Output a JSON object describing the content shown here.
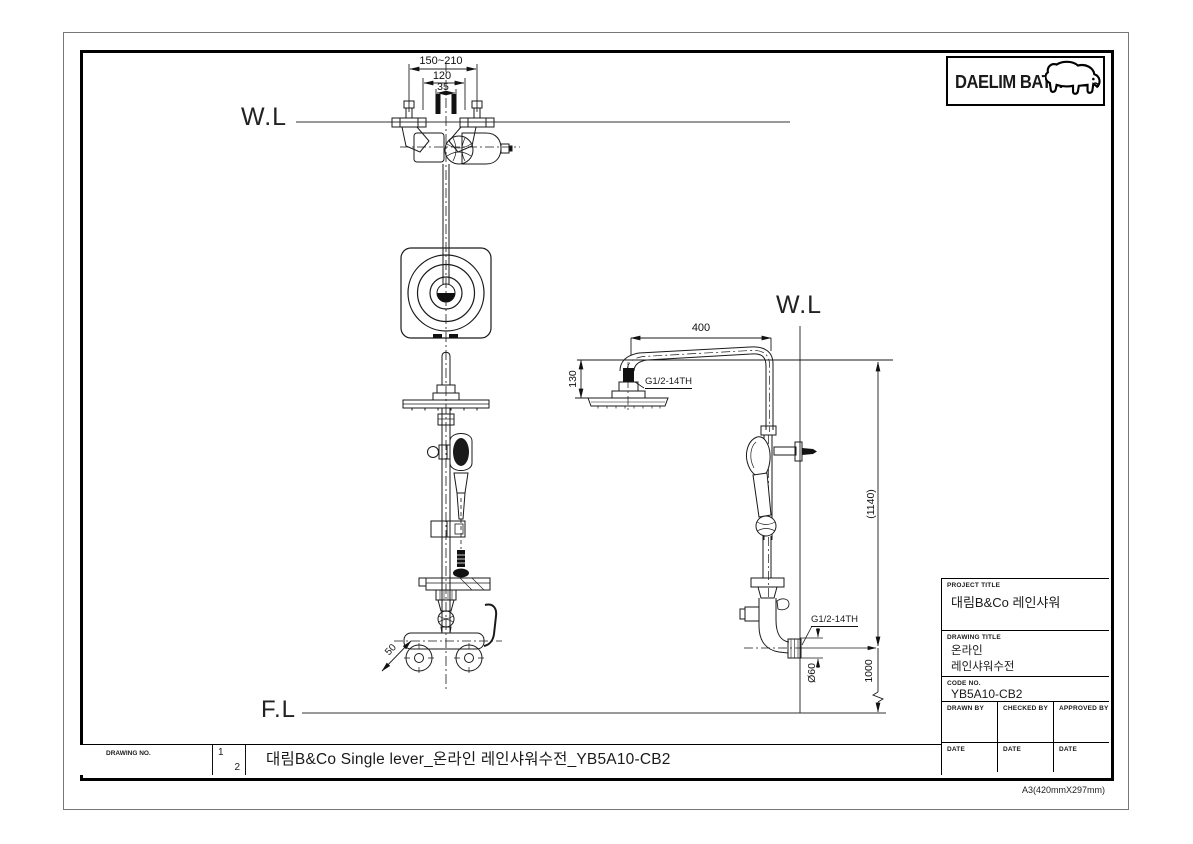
{
  "logo": {
    "brand": "DAELIM BATH"
  },
  "reference_lines": {
    "water_line_left": "W.L",
    "water_line_right": "W.L",
    "floor_line": "F.L"
  },
  "dimensions": {
    "inlet_adjust_range": "150~210",
    "inlet_center_distance": "120",
    "bolt_spacing": "35",
    "body_offset": "50",
    "arm_length": "400",
    "head_drop": "130",
    "head_thread": "G1/2-14TH",
    "inlet_thread": "G1/2-14TH",
    "overall_height": "(1140)",
    "valve_height": "1000",
    "flange_diameter": "Ø60"
  },
  "title_block": {
    "project_title_label": "PROJECT TITLE",
    "project_title": "대림B&Co 레인샤워",
    "drawing_title_label": "DRAWING TITLE",
    "drawing_title_line1": "온라인",
    "drawing_title_line2": "레인샤워수전",
    "code_no_label": "CODE NO.",
    "code_no": "YB5A10-CB2",
    "drawn_by_label": "DRAWN BY",
    "checked_by_label": "CHECKED BY",
    "approved_by_label": "APPROVED BY",
    "date_label_1": "DATE",
    "date_label_2": "DATE",
    "date_label_3": "DATE"
  },
  "footer": {
    "drawing_no_label": "DRAWING NO.",
    "sheet_number": "1",
    "sheet_total": "2",
    "drawing_title": "대림B&Co Single lever_온라인 레인샤워수전_YB5A10-CB2",
    "paper_size": "A3(420mmX297mm)"
  }
}
